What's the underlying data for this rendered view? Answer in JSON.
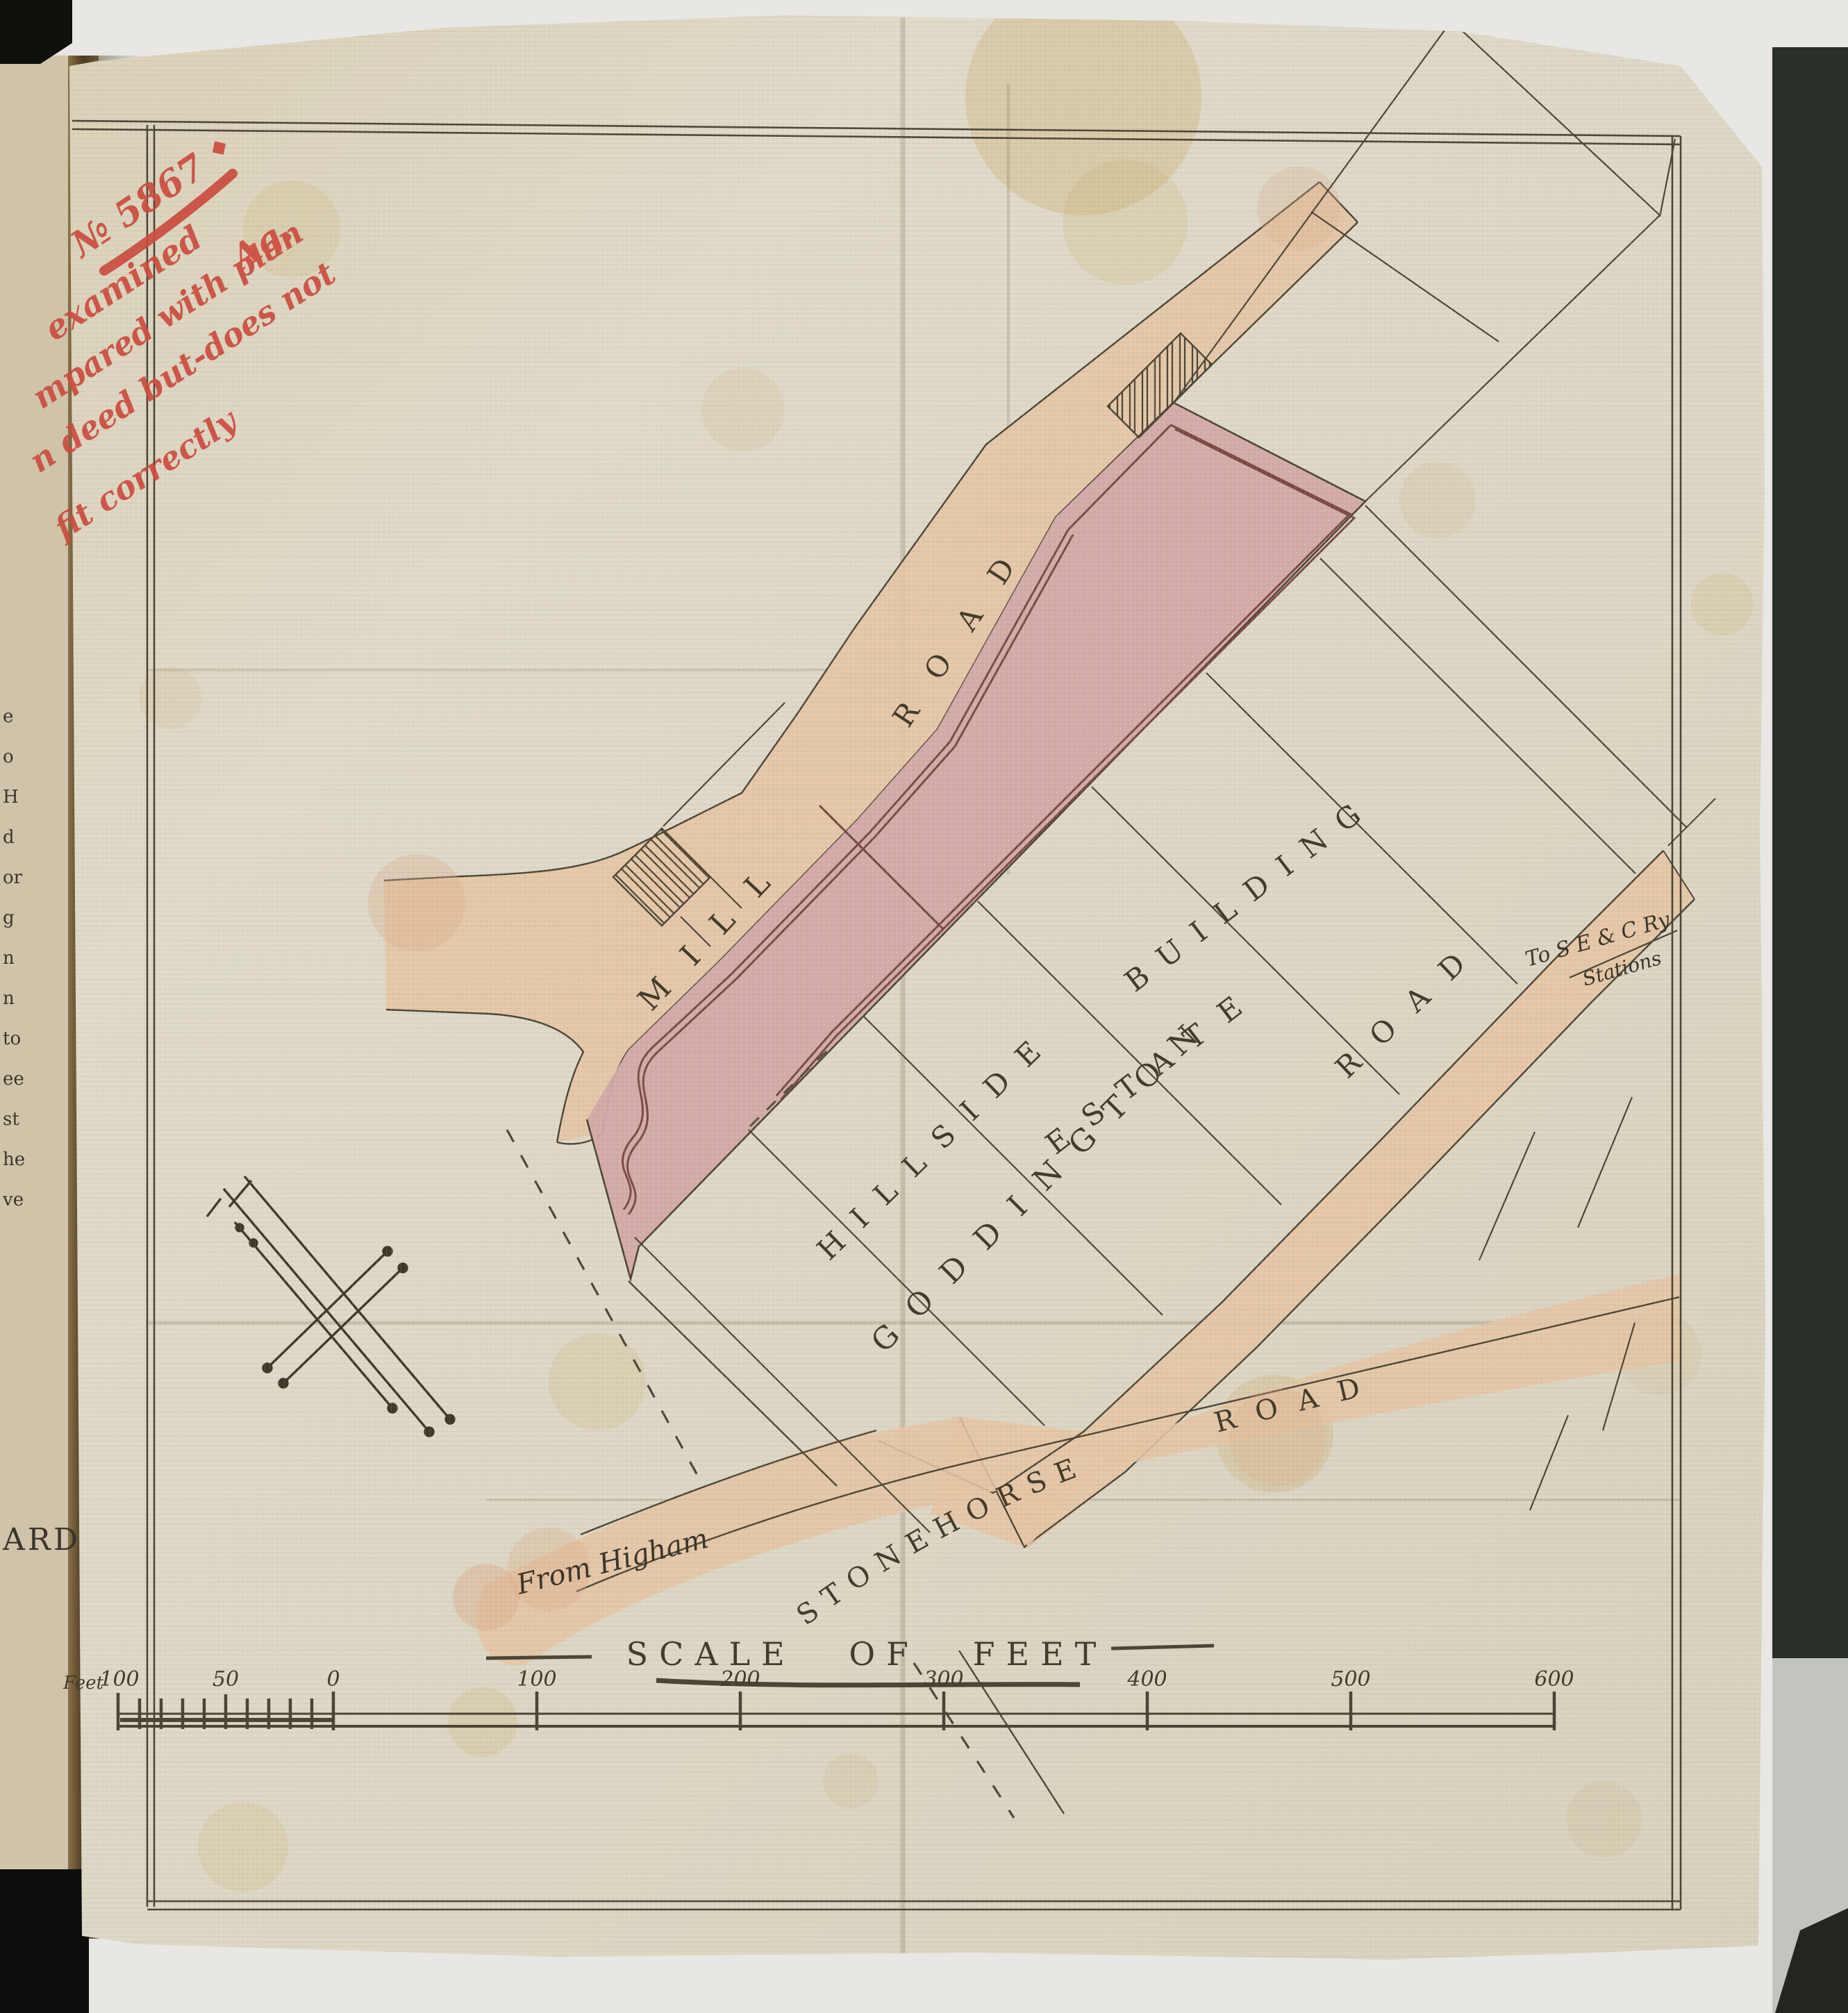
{
  "annotation": {
    "ref_no": "№ 5867",
    "line2": "examined",
    "line2_mark": "◆",
    "line3": "mpared with plan",
    "line4": "n deed but-does not",
    "line5": "fit correctly",
    "initials": "Ag."
  },
  "map": {
    "road_mill": {
      "word1": "MILL",
      "word2": "ROAD"
    },
    "road_goddington": {
      "word1": "GODDINGTON",
      "word2": "ROAD"
    },
    "road_stonehorse": {
      "word1": "STONEHORSE",
      "word2": "ROAD"
    },
    "estate": {
      "word1": "HILLSIDE",
      "word2": "ESTATE",
      "word3": "BUILDING"
    },
    "to_stations": {
      "line1": "To S E & C Ry",
      "line2": "Stations"
    },
    "from_higham": "From Higham"
  },
  "scale_bar": {
    "title": "SCALE OF FEET",
    "unit": "Feet",
    "tick_labels": [
      "100",
      "50",
      "0",
      "100",
      "200",
      "300",
      "400",
      "500",
      "600"
    ]
  },
  "book": {
    "left_page_fragments": [
      "e",
      "o",
      "H",
      "d",
      "or",
      "g",
      "n",
      "n",
      "to",
      "ee",
      "st",
      "he",
      "ve"
    ],
    "left_page_word": "ARD"
  },
  "colors": {
    "road_fill": "#e4c5a4",
    "estate_fill": "#d2a9a8",
    "ink": "#4c4536",
    "red_ink": "#cb4c40",
    "sheet": "#dbd5c2"
  }
}
